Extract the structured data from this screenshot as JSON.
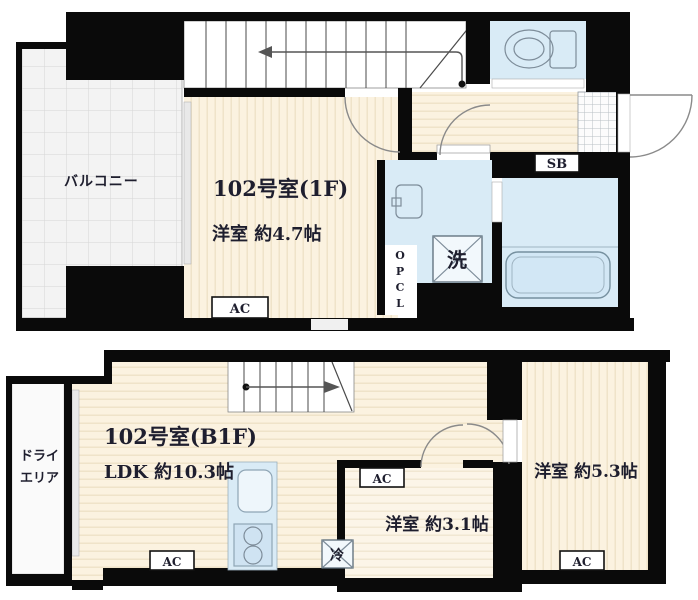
{
  "floor_1f": {
    "room_label": "102号室(1F)",
    "room_size": "洋室 約4.7帖",
    "balcony_label": "バルコニー",
    "shoe_box_label": "SB",
    "ac_label": "AC",
    "washer_label": "洗",
    "closet_letters": [
      "O",
      "P",
      "C",
      "L"
    ]
  },
  "floor_b1f": {
    "room_label": "102号室(B1F)",
    "ldk_size": "LDK 約10.3帖",
    "room_3_1_size": "洋室 約3.1帖",
    "room_5_3_size": "洋室 約5.3帖",
    "dry_area_line1": "ドライ",
    "dry_area_line2": "エリア",
    "ac_label": "AC",
    "fridge_label": "冷"
  },
  "colors": {
    "wall": "#0a0a0a",
    "floor_beige": "#fbf2e0",
    "fixture_blue": "#d9ebf6",
    "balcony_gray": "#f3f3f3"
  }
}
